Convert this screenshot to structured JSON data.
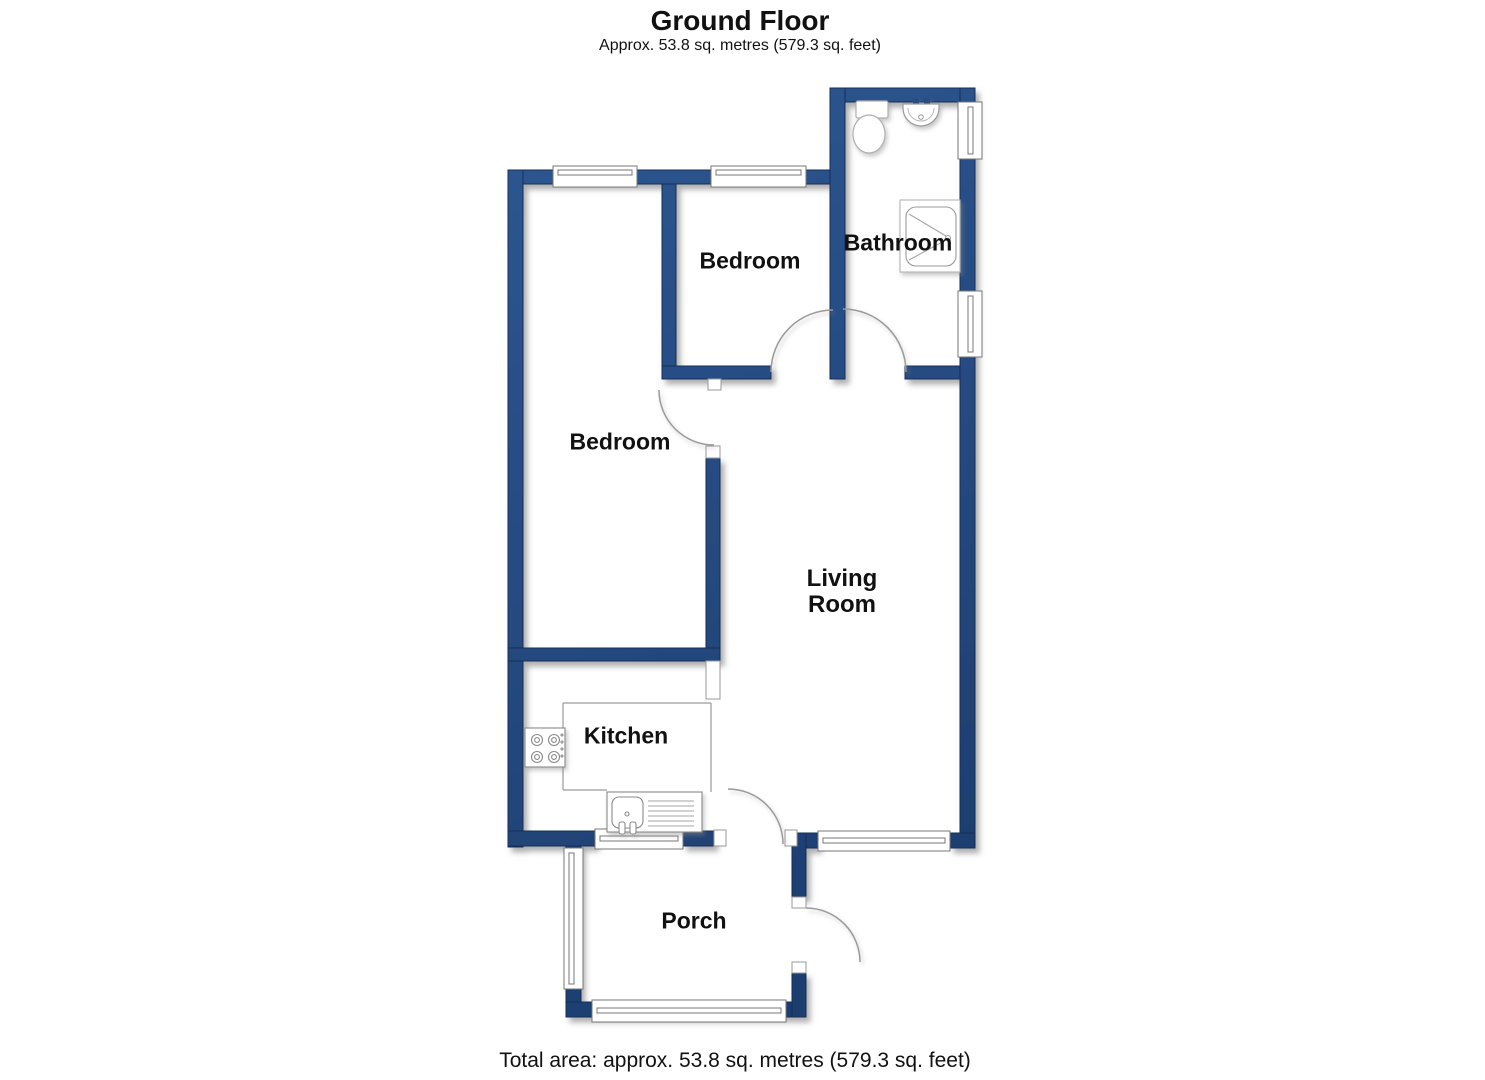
{
  "header": {
    "title": "Ground Floor",
    "subtitle": "Approx. 53.8 sq. metres (579.3 sq. feet)"
  },
  "rooms": {
    "bedroom_top": {
      "label": "Bedroom"
    },
    "bathroom": {
      "label": "Bathroom"
    },
    "bedroom_left": {
      "label": "Bedroom"
    },
    "living_room": {
      "label_line1": "Living",
      "label_line2": "Room"
    },
    "kitchen": {
      "label": "Kitchen"
    },
    "porch": {
      "label": "Porch"
    }
  },
  "footer": {
    "total_area": "Total area: approx. 53.8 sq. metres (579.3 sq. feet)"
  },
  "fixtures": {
    "toilet": "toilet",
    "basin": "wash-basin",
    "shower": "shower-tray",
    "hob": "cooker-hob",
    "sink": "kitchen-sink-drainer"
  },
  "colors": {
    "wall_light": "#2e5792",
    "wall_dark": "#1b3a6b",
    "wall_stroke": "#142e57",
    "line": "#999999",
    "text": "#111111",
    "background": "#ffffff"
  }
}
